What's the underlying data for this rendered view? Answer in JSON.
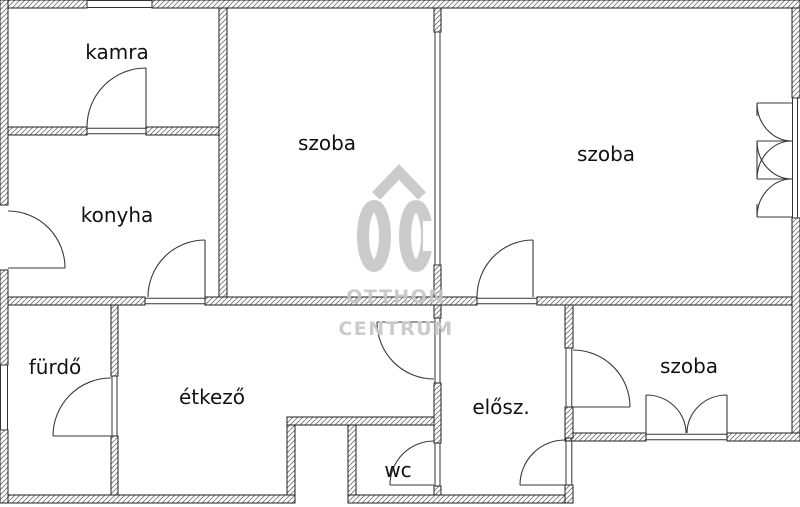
{
  "plan": {
    "title": "floor-plan",
    "rooms": [
      {
        "id": "kamra",
        "label": "kamra"
      },
      {
        "id": "szoba_top_middle",
        "label": "szoba"
      },
      {
        "id": "szoba_top_right",
        "label": "szoba"
      },
      {
        "id": "konyha",
        "label": "konyha"
      },
      {
        "id": "furdo",
        "label": "fürdő"
      },
      {
        "id": "etkezo",
        "label": "étkező"
      },
      {
        "id": "wc",
        "label": "wc"
      },
      {
        "id": "eloszoba",
        "label": "elősz."
      },
      {
        "id": "szoba_bottom_right",
        "label": "szoba"
      }
    ],
    "watermark": {
      "logo": "OC",
      "line1": "OTTHON",
      "line2": "CENTRUM"
    },
    "colors": {
      "background": "#ffffff",
      "wall_outline": "#1f1f1f",
      "hatch_line": "#6e6e6e",
      "door_line": "#3a3a3a",
      "opening_line": "#333333",
      "label_text": "#111111",
      "watermark": "#c6c6c6"
    }
  }
}
